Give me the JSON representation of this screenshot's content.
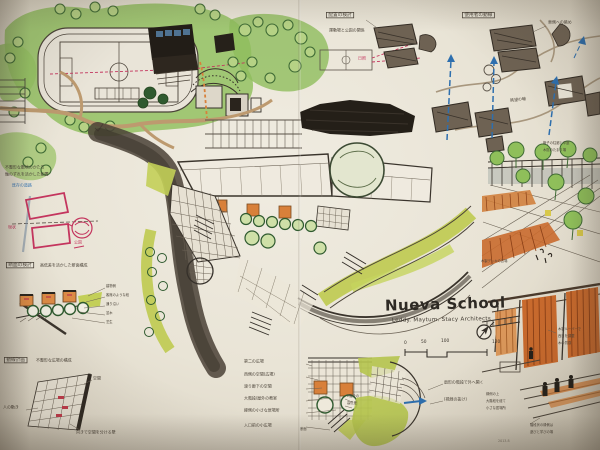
{
  "meta": {
    "kind": "hand-drawn architecture site analysis sketch",
    "project": "Nueva School"
  },
  "colors": {
    "paper": "#e9e4d6",
    "graphite": "#35302a",
    "road_dark": "#4a4136",
    "road_tan": "#bd9a6f",
    "park_green": "#93c161",
    "tree_green": "#3f6b35",
    "lime": "#bfcb52",
    "orange": "#d8803a",
    "deck_orange": "#c96a2d",
    "red_pink": "#c4355e",
    "arrow_blue": "#2e6fae",
    "window_blue": "#4f7291"
  },
  "title": {
    "main": "Nueva School",
    "sub": "Leddy. Maytum. Stacy Architects"
  },
  "compass": {
    "n": "N"
  },
  "scalebar": {
    "t0": "0",
    "t1": "50",
    "t2": "100",
    "t3": "120"
  },
  "panels": {
    "layout": {
      "box": "配置の検討",
      "note": "運動場と公園の関係",
      "sun": "日照"
    },
    "flow": {
      "box": "使用者の動線",
      "note_view": "東側への眺め",
      "note_axis": "眺望の軸"
    },
    "siteaxis": {
      "line1": "不整形な敷地のかたち",
      "line2": "軸のずれを活かした配置",
      "blue": "既存の道路",
      "tag_now": "現状",
      "tag_park": "公園"
    },
    "section": {
      "box": "断面の検討",
      "note": "高低差を活かした断面構成",
      "a1": "建物側",
      "a2": "客席のような段",
      "a3": "通り沿い",
      "a4": "並木",
      "a5": "芝生"
    },
    "circulation": {
      "box": "動線計画",
      "note": "不整形な広場の構成",
      "top": "空間",
      "left": "人の動き",
      "bottom": "向きで空間を分ける壁"
    },
    "plaza_list": {
      "i1": "第二の広場",
      "i2": "西側の空間(広場)",
      "i3": "渡り廊下の空間",
      "i4": "大階段/屋外の教室",
      "i5": "縁側の小さな居場所",
      "i6": "入口前の小広場",
      "r1": "2階分の",
      "r2": "高低差",
      "sec": "断面"
    },
    "fan": {
      "n1": "扇形の階段で外へ開く",
      "n2": "(視線の抜け)"
    },
    "court": {
      "n1": "格子の柱廊と中庭",
      "n2": "木陰のたまり場",
      "cap": "木製デッキの広場"
    },
    "veranda": {
      "r1": "木製ルーバーで",
      "r2": "西日を調整",
      "r3": "木の質感",
      "l1": "縁側の上",
      "l2": "大階段を経て",
      "l3": "小さな居場所",
      "b1": "階段状の縁側は",
      "b2": "遊びと学びの場",
      "date": "2013.8"
    }
  }
}
